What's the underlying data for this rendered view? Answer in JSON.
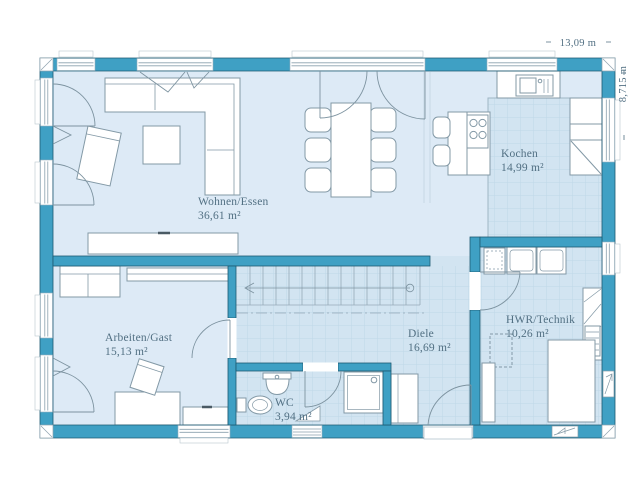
{
  "floor_plan": {
    "dimension_width_label": "13,09 m",
    "dimension_height_label": "8,715 m",
    "rooms": [
      {
        "name": "Wohnen/Essen",
        "area": "36,61 m²"
      },
      {
        "name": "Kochen",
        "area": "14,99 m²"
      },
      {
        "name": "Arbeiten/Gast",
        "area": "15,13 m²"
      },
      {
        "name": "Diele",
        "area": "16,69 m²"
      },
      {
        "name": "HWR/Technik",
        "area": "10,26 m²"
      },
      {
        "name": "WC",
        "area": "3,94 m²"
      }
    ],
    "colors": {
      "wall": "#3fa0c4",
      "wall_outline": "#1d5a72",
      "floor": "#ddeaf6",
      "floor_tiled": "#d2e4f1",
      "tile_grid": "#bfd7e8",
      "label_text": "#527083",
      "furniture_outline": "#8399a6"
    }
  }
}
